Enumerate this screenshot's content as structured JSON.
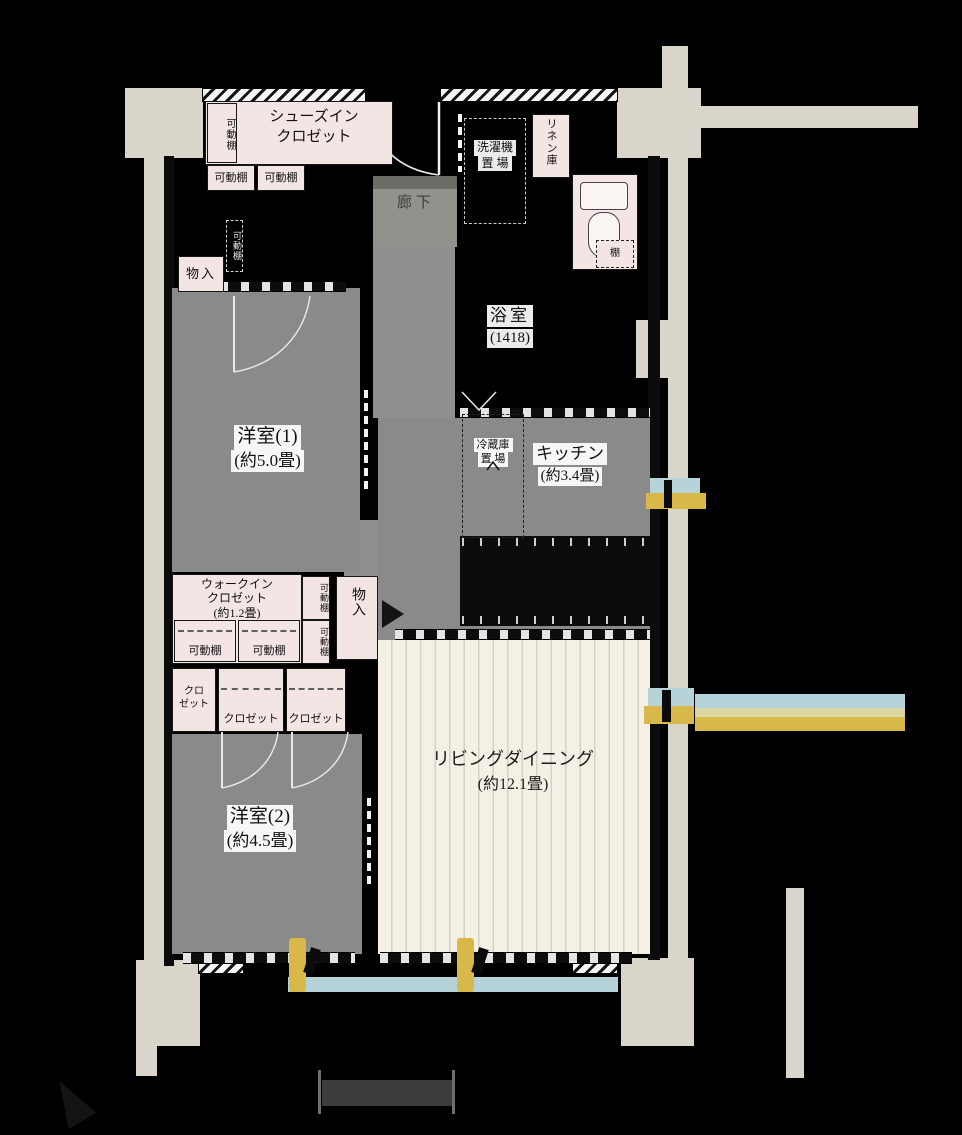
{
  "labels": {
    "bedroom1_name": "洋室(1)",
    "bedroom1_size": "(約5.0畳)",
    "bedroom2_name": "洋室(2)",
    "bedroom2_size": "(約4.5畳)",
    "living_name": "リビングダイニング",
    "living_size": "(約12.1畳)",
    "kitchen_name": "キッチン",
    "kitchen_size": "(約3.4畳)",
    "bath_name": "浴室",
    "bath_size": "(1418)",
    "wic_l1": "ウォークイン",
    "wic_l2": "クロゼット",
    "wic_size": "(約1.2畳)",
    "sic_l1": "シューズイン",
    "sic_l2": "クロゼット",
    "hallway": "廊下",
    "movable_shelf": "可動棚",
    "storage": "物入",
    "closet": "クロゼット",
    "closet_sm_l1": "クロ",
    "closet_sm_l2": "ゼット",
    "laundry_l1": "洗濯機",
    "laundry_l2": "置 場",
    "fridge_l1": "冷蔵庫",
    "fridge_l2": "置 場",
    "linen": "リネン庫",
    "shelf": "棚"
  },
  "colors": {
    "background": "#000000",
    "concrete": "#d9d5cb",
    "room_floor": "#8a8a8a",
    "living_floor": "#f4f0e5",
    "closet_fill": "#f3e5e4",
    "water_blue": "#b5d3d9",
    "gas_yellow": "#d9b84a",
    "pale_yellow": "#ded6a0"
  }
}
